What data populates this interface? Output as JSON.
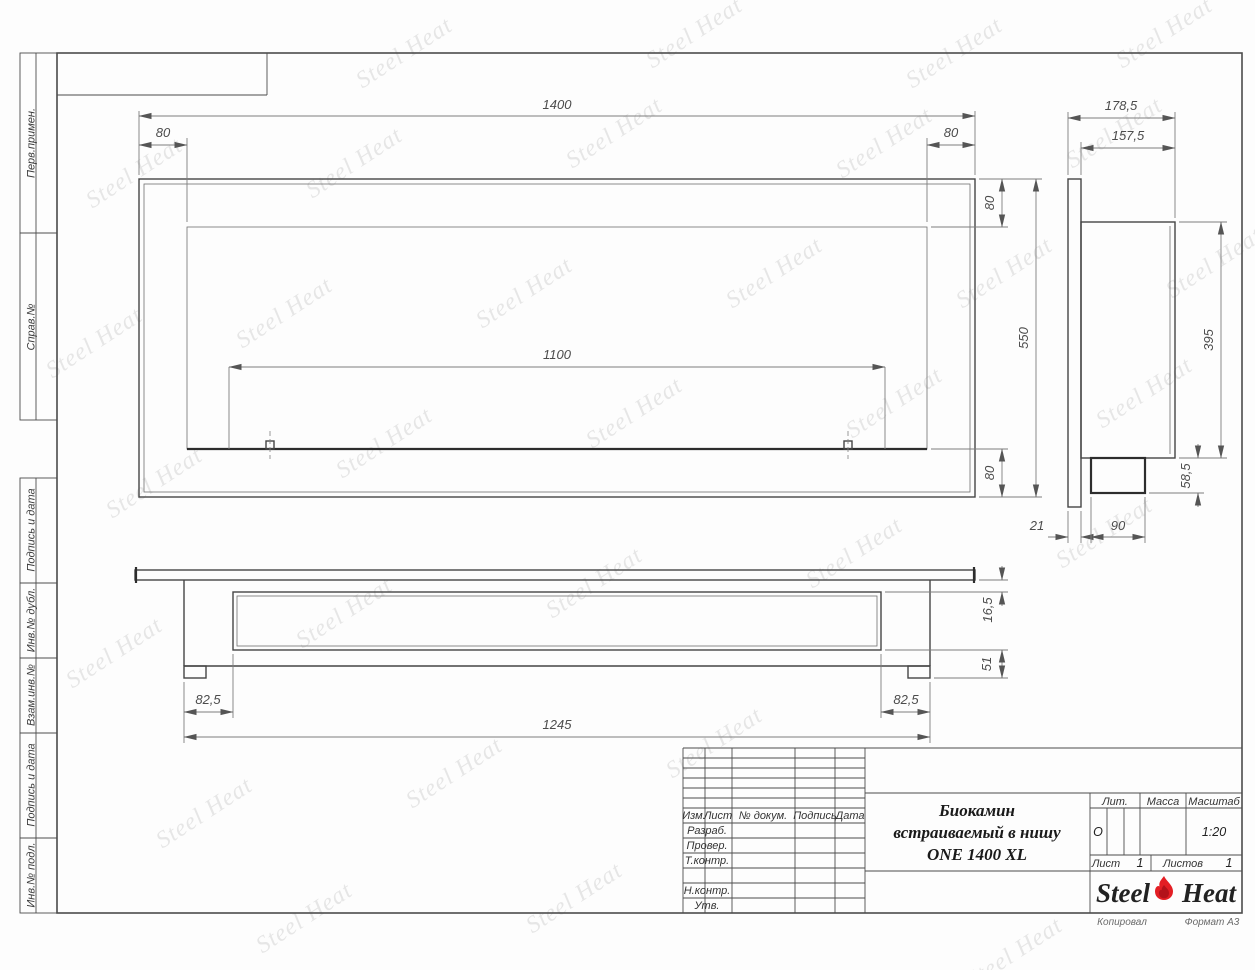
{
  "brand": {
    "watermark_text": "Steel Heat",
    "logo_left": "Steel",
    "logo_right": "Heat",
    "flame_color": "#e31e24"
  },
  "margin_column": {
    "labels": [
      "Перв.примен.",
      "Справ.№",
      "Подпись и дата",
      "Инв.№ дубл.",
      "Взам.инв.№",
      "Подпись и дата",
      "Инв.№ подл."
    ]
  },
  "views": {
    "front": {
      "width": "1400",
      "left_inset": "80",
      "right_inset": "80",
      "opening_width": "1100",
      "height": "550",
      "top_inset": "80",
      "bottom_inset": "80"
    },
    "side": {
      "depth_total": "178,5",
      "depth_body": "157,5",
      "body_height": "395",
      "box_height": "58,5",
      "flange_thickness": "21",
      "box_width": "90"
    },
    "bottom": {
      "edge_inset": "16,5",
      "base_height": "51",
      "left_margin": "82,5",
      "right_margin": "82,5",
      "length": "1245"
    }
  },
  "title_block": {
    "title_line1": "Биокамин",
    "title_line2": "встраиваемый в нишу",
    "title_line3": "ONE 1400 XL",
    "col_izm": "Изм.",
    "col_list": "Лист",
    "col_doc": "№ докум.",
    "col_sign": "Подпись",
    "col_date": "Дата",
    "row_developed": "Разраб.",
    "row_checked": "Провер.",
    "row_tcontrol": "Т.контр.",
    "row_ncontrol": "Н.контр.",
    "row_approved": "Утв.",
    "lit_label": "Лит.",
    "lit_value": "О",
    "mass_label": "Масса",
    "scale_label": "Масштаб",
    "scale_value": "1:20",
    "sheet_label": "Лист",
    "sheet_number": "1",
    "sheets_label": "Листов",
    "sheets_total": "1"
  },
  "footer": {
    "copied_label": "Копировал",
    "format_label": "Формат А3"
  }
}
